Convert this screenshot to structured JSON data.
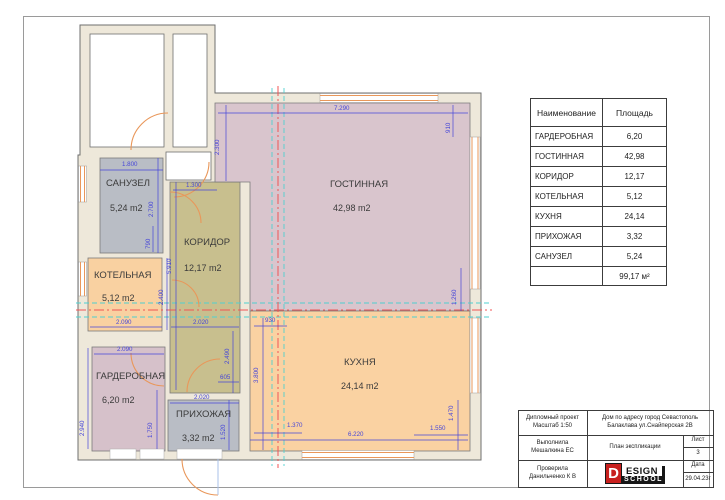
{
  "plan": {
    "colors": {
      "wall_fill": "#eee8da",
      "wall_stroke": "#6f6f6f",
      "dim": "#4646d8",
      "section_red": "#f05555",
      "section_teal": "#4fd0d0",
      "door": "#e9975a",
      "window": "#e9975a",
      "entry_leaf": "#a8c0e8",
      "label": "#3b3b3b"
    },
    "walls": {
      "footprint": "M 80 25 L 215 25 L 215 93 L 481 93 L 481 460 L 78 460 L 78 155 L 80 155 Z",
      "cavities": [
        {
          "x": 90,
          "y": 34,
          "w": 74,
          "h": 113
        },
        {
          "x": 173,
          "y": 34,
          "w": 34,
          "h": 113
        },
        {
          "x": 166,
          "y": 152,
          "w": 45,
          "h": 28
        }
      ]
    },
    "rooms": [
      {
        "id": "sanuzel",
        "name": "САНУЗЕЛ",
        "area": "5,24 m2",
        "color": "#b9bdc5",
        "rect": [
          100,
          158,
          63,
          95
        ],
        "label": [
          106,
          186
        ],
        "area_pos": [
          110,
          211
        ]
      },
      {
        "id": "kotelnaya",
        "name": "КОТЕЛЬНАЯ",
        "area": "5,12 m2",
        "color": "#f9d1a1",
        "rect": [
          88,
          258,
          74,
          73
        ],
        "label": [
          94,
          278
        ],
        "area_pos": [
          102,
          301
        ]
      },
      {
        "id": "garderobnaya",
        "name": "ГАРДЕРОБНАЯ",
        "area": "6,20 m2",
        "color": "#d6c1ca",
        "rect": [
          92,
          347,
          73,
          104
        ],
        "label": [
          96,
          379
        ],
        "area_pos": [
          102,
          403
        ]
      },
      {
        "id": "koridor",
        "name": "КОРИДОР",
        "area": "12,17 m2",
        "color": "#c8bf8e",
        "rect": [
          170,
          182,
          70,
          211
        ],
        "label": [
          184,
          245
        ],
        "area_pos": [
          184,
          271
        ]
      },
      {
        "id": "prihozhaya",
        "name": "ПРИХОЖАЯ",
        "area": "3,32 m2",
        "color": "#b9bdc5",
        "rect": [
          168,
          400,
          71,
          51
        ],
        "label": [
          176,
          417
        ],
        "area_pos": [
          182,
          441
        ]
      },
      {
        "id": "gostinnaya",
        "name": "ГОСТИННАЯ",
        "area": "42,98 m2",
        "color": "#d9c5cd",
        "poly": "215,103 470,103 470,311 250,311 250,182 215,182",
        "label": [
          330,
          187
        ],
        "area_pos": [
          333,
          211
        ]
      },
      {
        "id": "kuhnya",
        "name": "КУХНЯ",
        "area": "24,14 m2",
        "color": "#fad2a2",
        "rect": [
          250,
          311,
          220,
          140
        ],
        "label": [
          344,
          365
        ],
        "area_pos": [
          341,
          389
        ]
      }
    ],
    "windows": [
      {
        "o": "h",
        "x": 320,
        "y": 93.5,
        "len": 118,
        "th": 9
      },
      {
        "o": "v",
        "x": 470,
        "y": 137,
        "len": 152,
        "th": 10
      },
      {
        "o": "v",
        "x": 470,
        "y": 318,
        "len": 75,
        "th": 10
      },
      {
        "o": "h",
        "x": 302,
        "y": 450.5,
        "len": 112,
        "th": 9
      },
      {
        "o": "v",
        "x": 78.5,
        "y": 166,
        "len": 36,
        "th": 8
      },
      {
        "o": "v",
        "x": 78.5,
        "y": 262,
        "len": 34,
        "th": 8
      }
    ],
    "wall_gaps": [
      {
        "x": 110,
        "y": 449,
        "w": 26,
        "h": 10
      },
      {
        "x": 140,
        "y": 449,
        "w": 24,
        "h": 10
      },
      {
        "x": 177,
        "y": 449,
        "w": 45,
        "h": 10
      }
    ],
    "section_lines": [
      {
        "x1": 76,
        "y1": 303,
        "x2": 490,
        "y2": 303,
        "c": "teal"
      },
      {
        "x1": 76,
        "y1": 310,
        "x2": 492,
        "y2": 310,
        "c": "red"
      },
      {
        "x1": 76,
        "y1": 317,
        "x2": 490,
        "y2": 317,
        "c": "teal"
      },
      {
        "x1": 272,
        "y1": 88,
        "x2": 272,
        "y2": 466,
        "c": "teal"
      },
      {
        "x1": 278,
        "y1": 86,
        "x2": 278,
        "y2": 468,
        "c": "red"
      },
      {
        "x1": 284,
        "y1": 88,
        "x2": 284,
        "y2": 466,
        "c": "teal"
      }
    ],
    "doors": [
      "M 131 150 A 37 37 0 0 1 168 113",
      "M 209 162 A 35 35 0 0 1 174 197",
      "M 170 192 A 31 31 0 0 1 201 223",
      "M 172 280 A 27 27 0 0 1 199 307",
      "M 187 392 A 33 33 0 0 1 220 359",
      "M 131 353 A 33 33 0 0 0 164 386",
      "M 182 459 A 36 36 0 0 0 218 495"
    ],
    "entry_leaf": {
      "x1": 218,
      "y1": 459,
      "x2": 218,
      "y2": 495
    },
    "dims": [
      {
        "t": "7.290",
        "x": 334,
        "y": 110,
        "line": [
          218,
          113,
          468,
          113
        ]
      },
      {
        "t": "910",
        "x": 450,
        "y": 133,
        "rot": 1,
        "line": [
          453,
          105,
          453,
          137
        ]
      },
      {
        "t": "1.800",
        "x": 122,
        "y": 166,
        "line": [
          100,
          170,
          163,
          170
        ]
      },
      {
        "t": "2.700",
        "x": 153,
        "y": 217,
        "rot": 1,
        "line": [
          158,
          158,
          158,
          253
        ]
      },
      {
        "t": "790",
        "x": 150,
        "y": 249,
        "rot": 1,
        "line": [
          153,
          226,
          153,
          252
        ]
      },
      {
        "t": "1.300",
        "x": 186,
        "y": 187,
        "line": [
          173,
          190,
          217,
          190
        ]
      },
      {
        "t": "2.300",
        "x": 219,
        "y": 155,
        "rot": 1,
        "line": [
          226,
          105,
          226,
          181
        ]
      },
      {
        "t": "5.910",
        "x": 171,
        "y": 274,
        "rot": 1,
        "line": [
          176,
          182,
          176,
          390
        ]
      },
      {
        "t": "2.400",
        "x": 163,
        "y": 305,
        "rot": 1,
        "line": [
          167,
          258,
          167,
          330
        ]
      },
      {
        "t": "2.090",
        "x": 116,
        "y": 324,
        "line": [
          90,
          327,
          162,
          327
        ]
      },
      {
        "t": "2.020",
        "x": 193,
        "y": 324,
        "line": [
          171,
          327,
          239,
          327
        ]
      },
      {
        "t": "2.090",
        "x": 117,
        "y": 351,
        "line": [
          94,
          354,
          164,
          354
        ]
      },
      {
        "t": "2.490",
        "x": 229,
        "y": 364,
        "rot": 1,
        "line": [
          233,
          331,
          233,
          393
        ]
      },
      {
        "t": "605",
        "x": 220,
        "y": 379,
        "line": [
          218,
          382,
          239,
          382
        ]
      },
      {
        "t": "2.020",
        "x": 194,
        "y": 399,
        "line": [
          170,
          403,
          239,
          403
        ]
      },
      {
        "t": "2.940",
        "x": 84,
        "y": 436,
        "rot": 1,
        "line": [
          88,
          348,
          88,
          449
        ]
      },
      {
        "t": "1.750",
        "x": 152,
        "y": 438,
        "rot": 1,
        "line": [
          157,
          390,
          157,
          449
        ]
      },
      {
        "t": "1.520",
        "x": 225,
        "y": 440,
        "rot": 1,
        "line": [
          229,
          400,
          229,
          450
        ]
      },
      {
        "t": "3.800",
        "x": 258,
        "y": 383,
        "rot": 1,
        "line": [
          263,
          318,
          263,
          450
        ]
      },
      {
        "t": "930",
        "x": 265,
        "y": 322,
        "line": [
          254,
          326,
          287,
          326
        ]
      },
      {
        "t": "1.370",
        "x": 287,
        "y": 427,
        "line": [
          254,
          433,
          302,
          433
        ]
      },
      {
        "t": "6.220",
        "x": 348,
        "y": 436,
        "line": [
          250,
          440,
          468,
          440
        ]
      },
      {
        "t": "1.550",
        "x": 430,
        "y": 430,
        "line": [
          414,
          435,
          468,
          435
        ]
      },
      {
        "t": "1.470",
        "x": 453,
        "y": 421,
        "rot": 1,
        "line": [
          458,
          400,
          458,
          450
        ]
      },
      {
        "t": "1.260",
        "x": 456,
        "y": 305,
        "rot": 1,
        "line": [
          461,
          268,
          461,
          311
        ]
      }
    ]
  },
  "area_table": {
    "col_name": "Наименование",
    "col_area": "Площадь",
    "rows": [
      {
        "name": "ГАРДЕРОБНАЯ",
        "value": "6,20"
      },
      {
        "name": "ГОСТИННАЯ",
        "value": "42,98"
      },
      {
        "name": "КОРИДОР",
        "value": "12,17"
      },
      {
        "name": "КОТЕЛЬНАЯ",
        "value": "5,12"
      },
      {
        "name": "КУХНЯ",
        "value": "24,14"
      },
      {
        "name": "ПРИХОЖАЯ",
        "value": "3,32"
      },
      {
        "name": "САНУЗЕЛ",
        "value": "5,24"
      }
    ],
    "total": "99,17 м²"
  },
  "title_block": {
    "project_line1": "Дипломный проект",
    "project_line2": "Масштаб 1:50",
    "address_line1": "Дом по адресу город Севастополь",
    "address_line2": "Балаклава ул.Снайперская 2В",
    "author_line1": "Выполнила",
    "author_line2": "Мешалкина ЕС",
    "doc_title": "План экспликации",
    "sheet_label": "Лист",
    "sheet_number": "3",
    "checker_line1": "Проверила",
    "checker_line2": "Данильченко К В",
    "date_label": "Дата",
    "date_value": "29.04.23г",
    "logo": {
      "d": "D",
      "esign": "ESIGN",
      "school": "SCHOOL"
    }
  }
}
